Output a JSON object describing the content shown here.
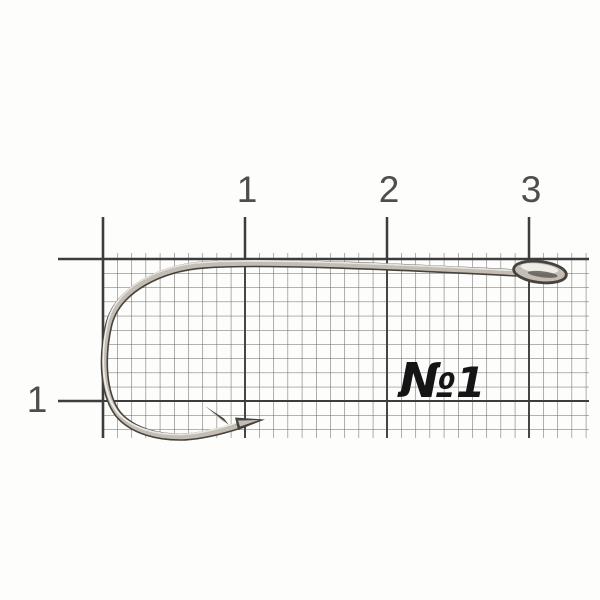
{
  "ruler": {
    "top_tick_labels": [
      "1",
      "2",
      "3"
    ],
    "left_tick_labels": [
      "1"
    ]
  },
  "annotation": {
    "size_prefix": "№",
    "size_number": "1"
  },
  "colors": {
    "paper": "#fdfdfc",
    "grid_fine": "#666666",
    "grid_major": "#3d3d3d",
    "label_text": "#4e4e4e",
    "annotation_text": "#151515",
    "hook_dark": "#46433e",
    "hook_mid": "#c3bdb3",
    "hook_highlight": "#f4f2ed"
  }
}
